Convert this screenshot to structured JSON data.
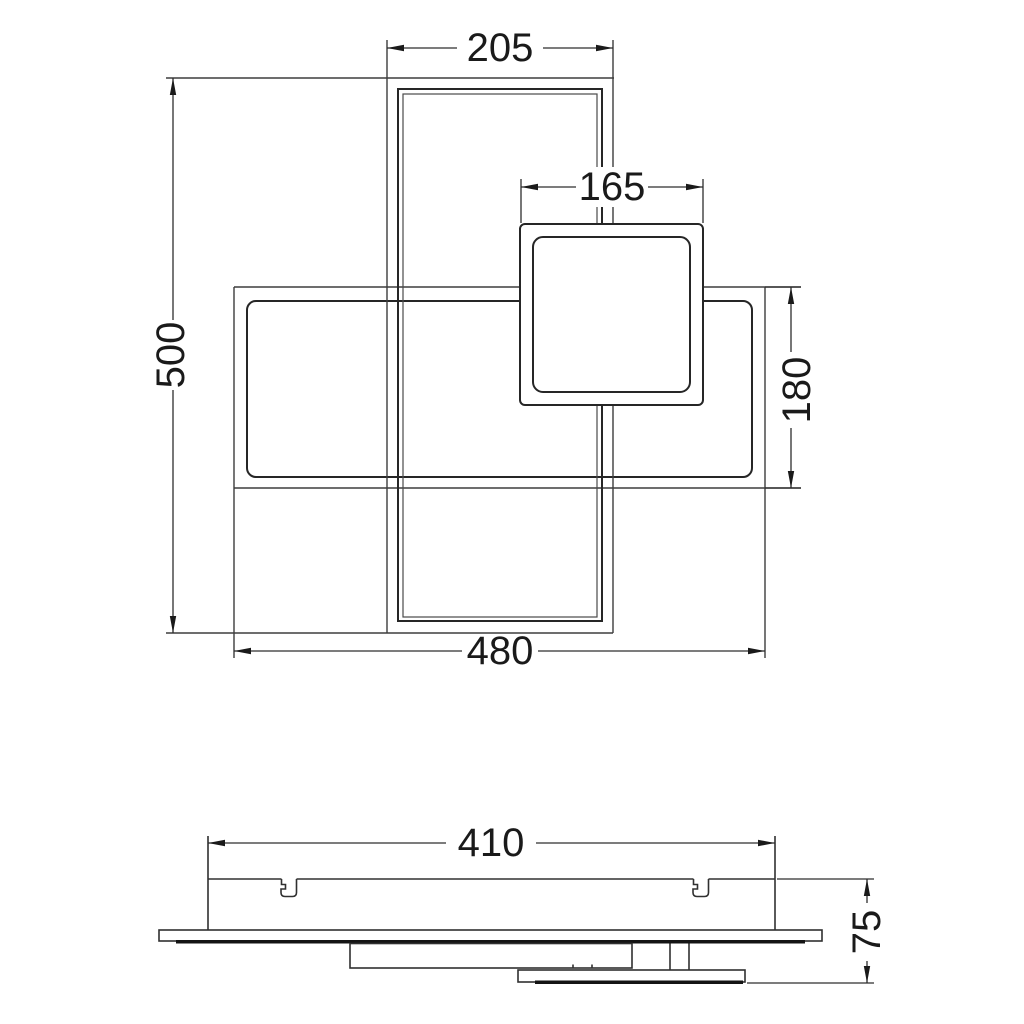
{
  "drawing": {
    "title": "ceiling-lamp-dimension-drawing",
    "colors": {
      "background": "#ffffff",
      "line": "#3d3d3d",
      "frame_line": "#262626",
      "dimension_line": "#2e2e2e",
      "text": "#1a1a1a",
      "dark_bar": "#141414"
    },
    "top_view": {
      "vertical_frame_width": "205",
      "square_frame_width": "165",
      "vertical_frame_height": "500",
      "horizontal_frame_height": "180",
      "horizontal_frame_width": "480"
    },
    "side_view": {
      "mount_body_width": "410",
      "overall_height": "75"
    }
  }
}
